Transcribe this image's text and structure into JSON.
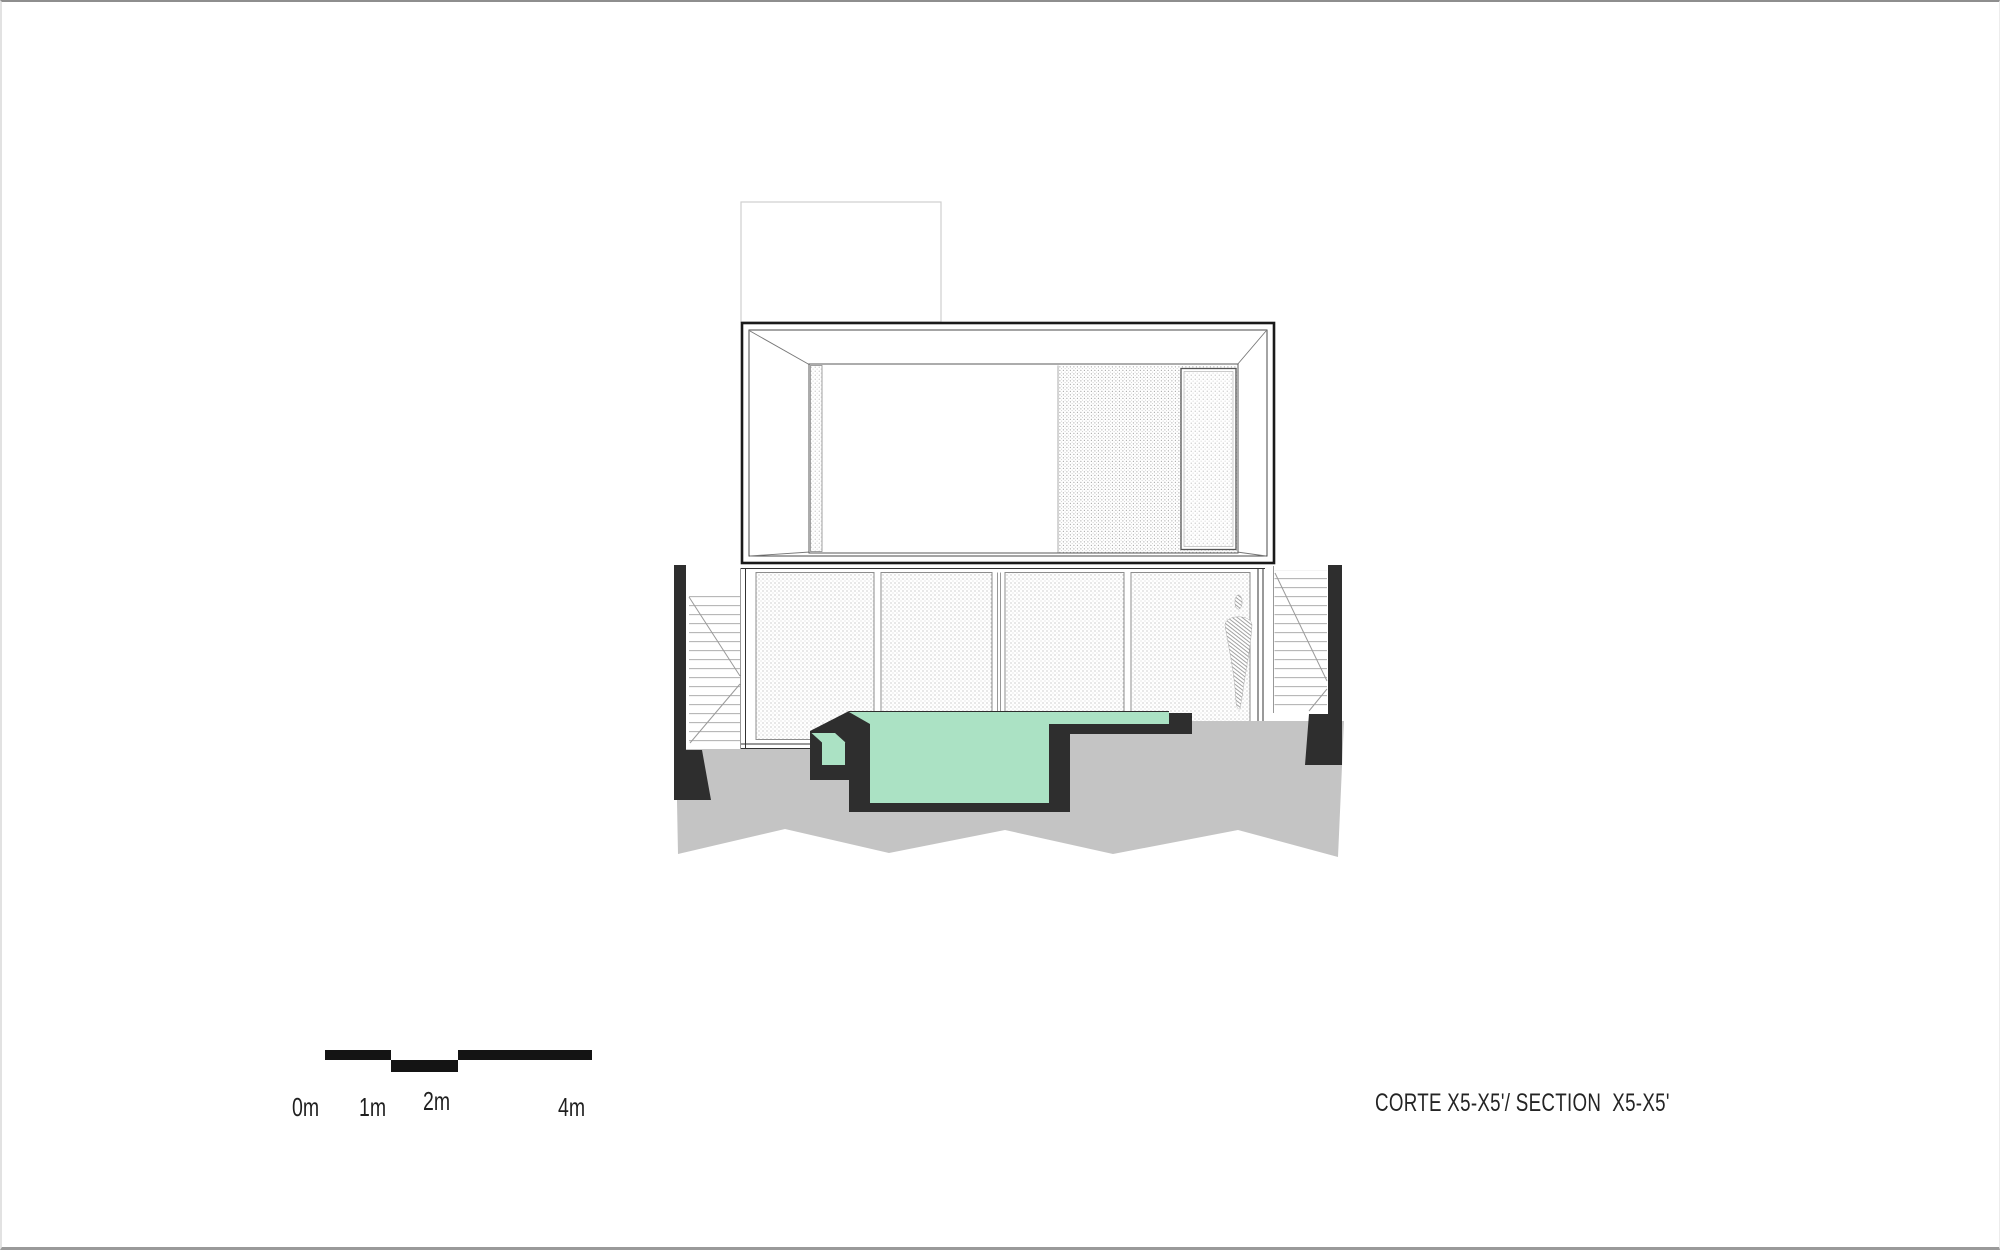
{
  "drawing_title": {
    "text": "CORTE X5-X5'/ SECTION  X5-X5'"
  },
  "scale_bar": {
    "labels": [
      "0m",
      "1m",
      "2m",
      "4m"
    ]
  },
  "colors": {
    "pool_water": "#abe2c4",
    "structure_dark": "#2e2e2e",
    "ground": "#c4c4c4",
    "scale_bar_black": "#141414",
    "roof_outline": "#cfcfcf",
    "frame_dark": "#1a1a1a",
    "hatch_dot": "#b0b0b0",
    "hatch_dot_dense": "#a5a5a5",
    "louver_line": "#b5b5b5",
    "diagonal_line": "#9a9a9a",
    "figure_hatch": "#8a8a8a",
    "background": "#ffffff"
  }
}
